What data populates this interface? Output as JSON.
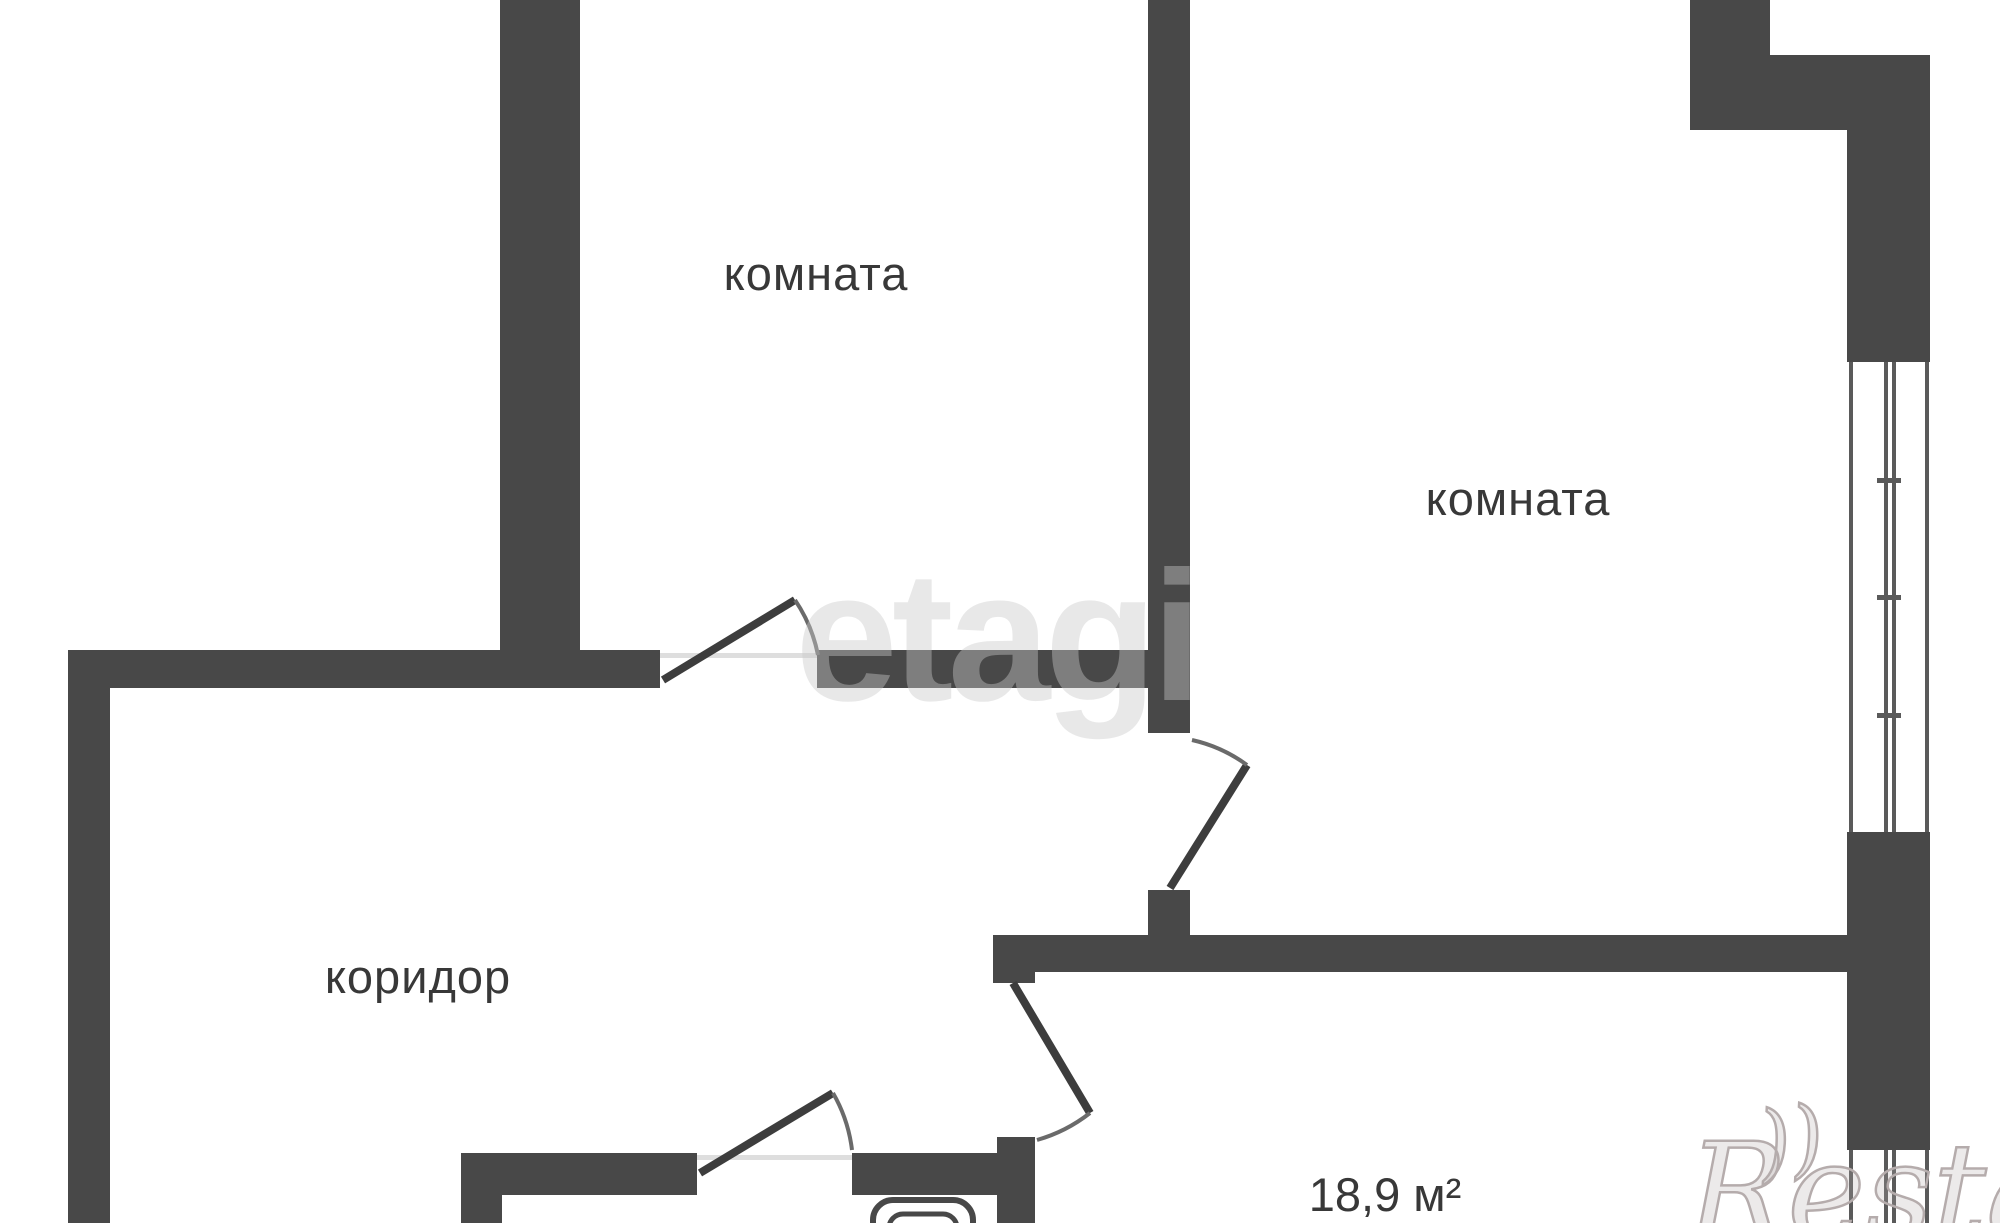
{
  "plan": {
    "type": "apartment-floor-plan",
    "colors": {
      "background": "#ffffff",
      "wall": "#484848",
      "door-line": "#3d3d3d",
      "arc-line": "#6a6a6a",
      "window-line": "#5a5a5a",
      "label": "#383838",
      "threshold": "#dedede",
      "watermark": "#c9c9c9",
      "watermark-outline": "#b5acac"
    },
    "labels": {
      "room_top_left": "комната",
      "room_right": "комната",
      "corridor": "коридор",
      "bottom_room_area": "18,9 м²"
    },
    "watermarks": {
      "agency": "etagi",
      "portal": "Restate",
      "portal_flourish": "))"
    },
    "features": {
      "doors": 4,
      "windows": 2,
      "fixtures": [
        "sink-icon"
      ]
    }
  }
}
